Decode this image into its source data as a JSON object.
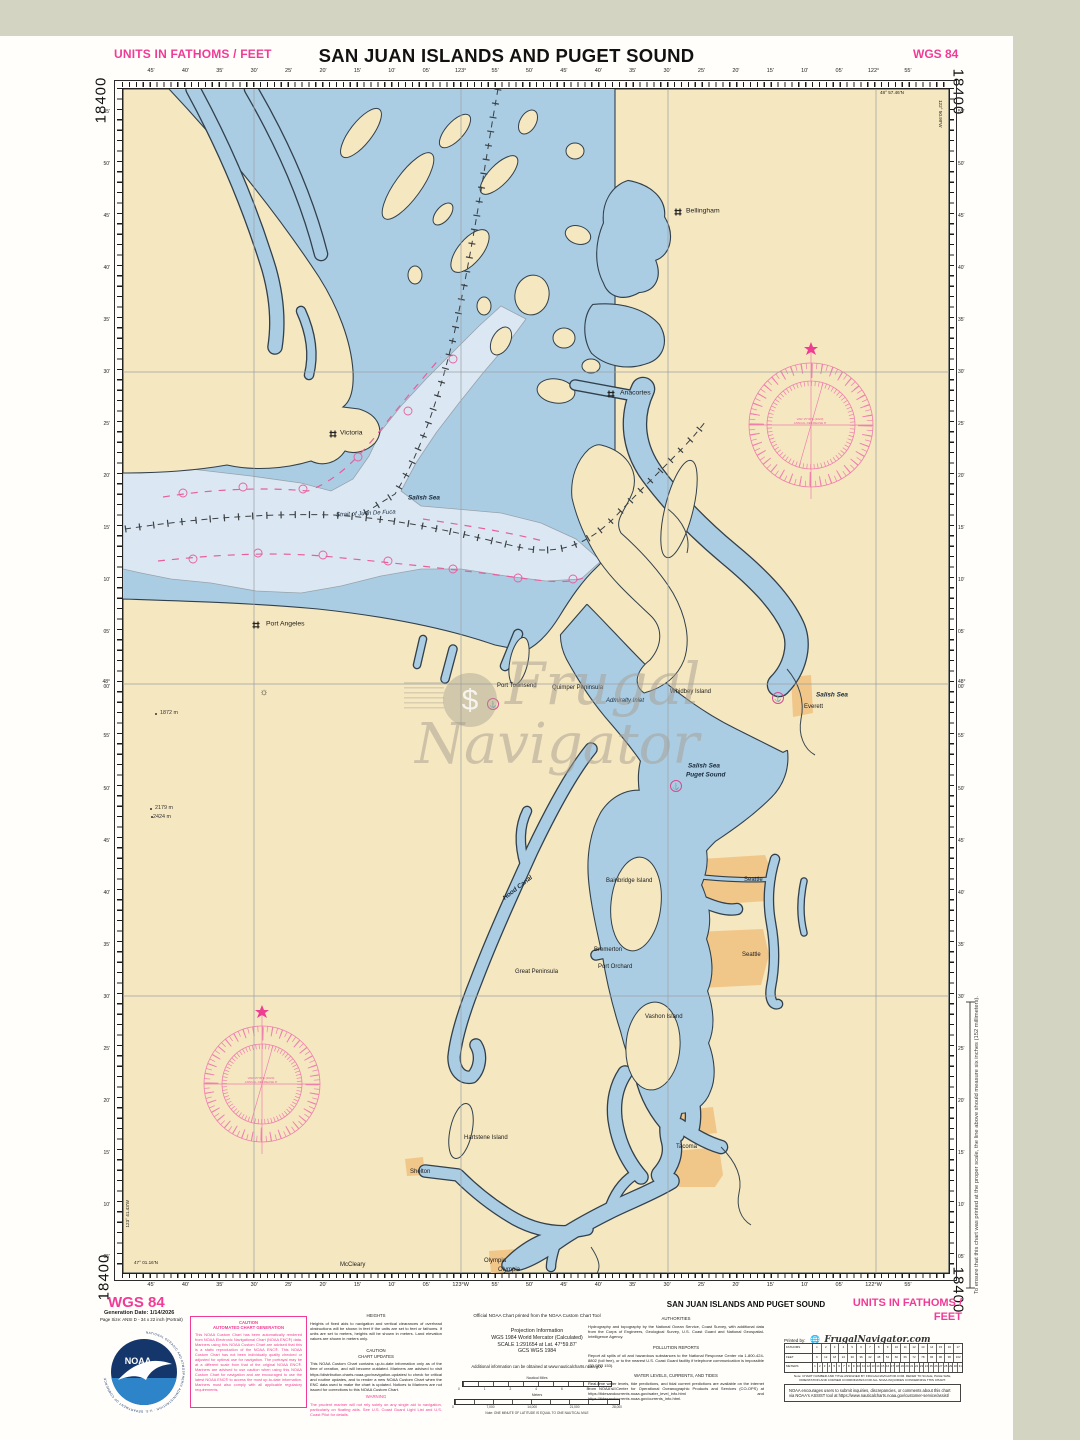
{
  "colors": {
    "page_bg": "#d3d5c2",
    "water": "#abcde3",
    "water_light": "#dbe8f4",
    "land": "#f5e7c0",
    "urban": "#f1c689",
    "coastline": "#31404c",
    "magenta": "#f13b96",
    "compass_rose": "#ef7fae",
    "noaa_navy": "#15366b",
    "noaa_blue": "#2d84c8"
  },
  "chart_number": "18400",
  "header": {
    "units": "UNITS IN FATHOMS / FEET",
    "title": "SAN JUAN ISLANDS AND PUGET SOUND",
    "datum": "WGS 84"
  },
  "corners": {
    "top_right_lat": "48° 57.46'N",
    "top_right_lon": "122° 50.99'W",
    "bottom_left_lat": "47° 01.16'N",
    "bottom_left_lon": "123° 41.43'W"
  },
  "rulers": {
    "top": [
      "45'",
      "40'",
      "35'",
      "30'",
      "25'",
      "20'",
      "15'",
      "10'",
      "05'",
      "123°",
      "55'",
      "50'",
      "45'",
      "40'",
      "35'",
      "30'",
      "25'",
      "20'",
      "15'",
      "10'",
      "05'",
      "122°",
      "55'"
    ],
    "bottom": [
      "45'",
      "40'",
      "35'",
      "30'",
      "25'",
      "20'",
      "15'",
      "10'",
      "05'",
      "123°W",
      "55'",
      "50'",
      "45'",
      "40'",
      "35'",
      "30'",
      "25'",
      "20'",
      "15'",
      "10'",
      "05'",
      "122°W",
      "55'"
    ],
    "left": [
      "55'",
      "50'",
      "45'",
      "40'",
      "35'",
      "30'",
      "25'",
      "20'",
      "15'",
      "10'",
      "05'",
      "48°\n00'",
      "55'",
      "50'",
      "45'",
      "40'",
      "35'",
      "30'",
      "25'",
      "20'",
      "15'",
      "10'",
      "05'"
    ],
    "right": [
      "55'",
      "50'",
      "45'",
      "40'",
      "35'",
      "30'",
      "25'",
      "20'",
      "15'",
      "10'",
      "05'",
      "48°\n00'",
      "55'",
      "50'",
      "45'",
      "40'",
      "35'",
      "30'",
      "25'",
      "20'",
      "15'",
      "10'",
      "05'"
    ]
  },
  "map": {
    "labels": [
      {
        "text": "Victoria"
      },
      {
        "text": "Bellingham"
      },
      {
        "text": "Anacortes"
      },
      {
        "text": "Port Angeles"
      },
      {
        "text": "Port Townsend"
      },
      {
        "text": "Quimper Peninsula"
      },
      {
        "text": "Admiralty Inlet"
      },
      {
        "text": "Whidbey Island"
      },
      {
        "text": "Salish Sea"
      },
      {
        "text": "Everett"
      },
      {
        "text": "Salish Sea"
      },
      {
        "text": "Puget Sound"
      },
      {
        "text": "Salish Sea"
      },
      {
        "text": "Strait of Juan De Fuca"
      },
      {
        "text": "Hood Canal"
      },
      {
        "text": "Bainbridge Island"
      },
      {
        "text": "Seattle"
      },
      {
        "text": "Seattle"
      },
      {
        "text": "Bremerton"
      },
      {
        "text": "Port Orchard"
      },
      {
        "text": "Great Peninsula"
      },
      {
        "text": "Vashon Island"
      },
      {
        "text": "Tacoma"
      },
      {
        "text": "Hartstene Island"
      },
      {
        "text": "Shelton"
      },
      {
        "text": "McCleary"
      },
      {
        "text": "Olympia"
      },
      {
        "text": "Olympia"
      },
      {
        "text": "1872 m"
      },
      {
        "text": "2179 m"
      },
      {
        "text": "2424 m"
      }
    ],
    "compass_rose_line1": "VAR 15°30'E (2020)",
    "compass_rose_line2": "ANNUAL DECREASE 8'"
  },
  "margin_note": "To ensure that this chart was printed at the proper scale, the line above should measure six inches (152 millimeters).",
  "legend": {
    "wgs": "WGS 84",
    "gen_date": "Generation Date: 1/14/2026",
    "page_size": "Page Size: ANSI D - 34 x 22 inch (Portrait)",
    "noaa_ring": "NATIONAL OCEANIC AND ATMOSPHERIC ADMINISTRATION · U.S. DEPARTMENT OF COMMERCE",
    "noaa_word": "NOAA",
    "caution_box": {
      "t": "CAUTION\nAUTOMATED CHART GENERATION",
      "body": "This NOAA Custom Chart has been automatically rendered from NOAA Electronic Navigational Chart (NOAA ENC®) data. Mariners using this NOAA Custom Chart are advised that this is a static reproduction of the NOAA ENC®. This NOAA Custom Chart has not been individually quality checked or adjusted for optimal use for navigation. The portrayal may be at a different scale from that of the original NOAA ENC®. Mariners are advised to use caution when using this NOAA Custom Chart for navigation and are encouraged to use the latest NOAA ENC® to access the most up-to-date information. Mariners must also comply with all applicable regulatory requirements."
    },
    "heights": {
      "t": "HEIGHTS",
      "body": "Heights of fixed aids to navigation and vertical clearances of overhead obstructions will be shown in feet if the units are set to feet or fathoms. If units are set to meters, heights will be shown in meters. Land elevation values are shown in meters only."
    },
    "chart_updates": {
      "t": "CAUTION\nCHART UPDATES",
      "body": "This NOAA Custom Chart contains up-to-date information only as of the time of creation, and will become outdated. Mariners are advised to visit https://distribution.charts.noaa.gov/navigation-updates/ to check for critical and routine updates, and to render a new NOAA Custom Chart when the ENC data used to make the chart is updated. Notices to Mariners are not issued for corrections to this NOAA Custom Chart."
    },
    "warning": {
      "t": "WARNING",
      "body": "The prudent mariner will not rely solely on any single aid to navigation, particularly on floating aids. See U.S. Coast Guard Light List and U.S. Coast Pilot for details."
    },
    "official": "Official NOAA Chart printed from the NOAA Custom Chart Tool",
    "projection": {
      "t": "Projection Information",
      "l1": "WGS 1984 World Mercator (Calculated)",
      "l2": "SCALE 1:291654 at Lat. 47°59.87'",
      "l3": "GCS WGS 1984"
    },
    "additional": "Additional information can be obtained at www.nauticalcharts.noaa.gov",
    "scalebars": {
      "nm_label": "Nautical Miles",
      "nm_ticks": [
        "0",
        "1",
        "2",
        "4",
        "6",
        "8",
        "10"
      ],
      "m_label": "Meters",
      "m_ticks": [
        "0",
        "7,000",
        "14,000",
        "21,000",
        "28,000"
      ],
      "note": "Note: ONE MINUTE OF LATITUDE IS EQUAL TO ONE NAUTICAL MILE"
    },
    "title2": "SAN JUAN ISLANDS AND PUGET SOUND",
    "units2": "UNITS IN FATHOMS / FEET",
    "authorities": {
      "t": "AUTHORITIES",
      "body": "Hydrography and topography by the National Ocean Service, Coast Survey, with additional data from the Corps of Engineers, Geological Survey, U.S. Coast Guard and National Geospatial-Intelligence Agency."
    },
    "pollution": {
      "t": "POLLUTION REPORTS",
      "body": "Report all spills of oil and hazardous substances to the National Response Center via 1-800-424-8802 (toll free), or to the nearest U.S. Coast Guard facility if telephone communication is impossible (33 CFR 153)."
    },
    "water_levels": {
      "t": "WATER LEVELS, CURRENTS, AND TIDES",
      "body": "Real-time water levels, tide predictions, and tidal current predictions are available on the internet from NOAA's Center for Operational Oceanographic Products and Services (CO-OPS) at https://tidesandcurrents.noaa.gov/water_level_info.html and https://tidesandcurrents.noaa.gov/currents_info.html."
    },
    "printed_by": "Printed by:",
    "brand": "FrugalNavigator.com",
    "units_table": {
      "rows": [
        {
          "label": "FATHOMS",
          "values": [
            "1",
            "2",
            "3",
            "4",
            "5",
            "6",
            "7",
            "8",
            "9",
            "10",
            "11",
            "12",
            "13",
            "14",
            "15",
            "16",
            "17"
          ]
        },
        {
          "label": "FEET",
          "values": [
            "6",
            "12",
            "18",
            "24",
            "30",
            "36",
            "42",
            "48",
            "54",
            "60",
            "66",
            "72",
            "78",
            "84",
            "90",
            "96",
            "102"
          ]
        },
        {
          "label": "METERS",
          "values": [
            "1",
            "2",
            "3",
            "4",
            "5",
            "6",
            "7",
            "8",
            "9",
            "10",
            "11",
            "12",
            "13",
            "14",
            "15",
            "16",
            "17",
            "18",
            "19",
            "20",
            "21",
            "22",
            "23",
            "24",
            "25",
            "26",
            "27",
            "28",
            "29",
            "30",
            "31"
          ]
        }
      ]
    },
    "table_note": "Note: CHART NUMBER AND TITLE ASSIGNED BY FRUGALNAVIGATOR.COM. REFER TO SCALE, PAGE SIZE, ORIENTATION AND CORNER COORDINATES FOR ALL NOAA INQUIRIES CONCERNING THIS CHART.",
    "assist": "NOAA encourages users to submit inquiries, discrepancies, or comments about this chart via NOAA's ASSIST tool at https://www.nauticalcharts.noaa.gov/customer-service/assist/"
  }
}
